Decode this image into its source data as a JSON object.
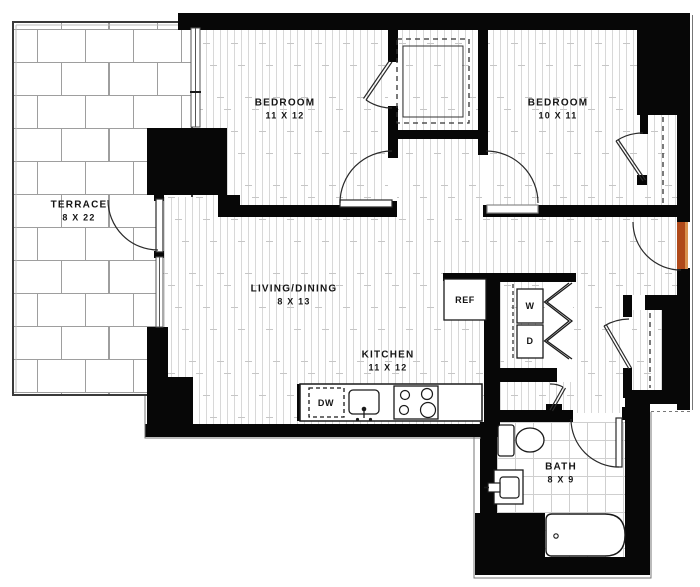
{
  "meta": {
    "title": "Two-bedroom apartment floor plan",
    "canvas_width": 700,
    "canvas_height": 587
  },
  "colors": {
    "wall": "#070707",
    "entry_door": "#b04a1a",
    "entry_door_edge": "#d9924f",
    "label": "#141414",
    "plank_line": "#d8d8d8",
    "brick_line": "#9e9e9e",
    "tile_line": "#cfcfcf"
  },
  "rooms": [
    {
      "id": "terrace",
      "name": "TERRACE",
      "dims": "8 X 22"
    },
    {
      "id": "bedroom1",
      "name": "BEDROOM",
      "dims": "11 X 12"
    },
    {
      "id": "bedroom2",
      "name": "BEDROOM",
      "dims": "10 X 11"
    },
    {
      "id": "living",
      "name": "LIVING/DINING",
      "dims": "8 X 13"
    },
    {
      "id": "kitchen",
      "name": "KITCHEN",
      "dims": "11 X 12"
    },
    {
      "id": "bath",
      "name": "BATH",
      "dims": "8 X 9"
    }
  ],
  "appliances": {
    "washer": "W",
    "dryer": "D",
    "dishwasher": "DW",
    "refrigerator": "REF"
  },
  "fixtures": [
    "toilet",
    "bathtub",
    "vanity-sink",
    "kitchen-sink",
    "stove",
    "dishwasher",
    "refrigerator",
    "washer-dryer-stack",
    "entry-door",
    "terrace-door",
    "closet-rod",
    "bifold-doors",
    "windows"
  ]
}
